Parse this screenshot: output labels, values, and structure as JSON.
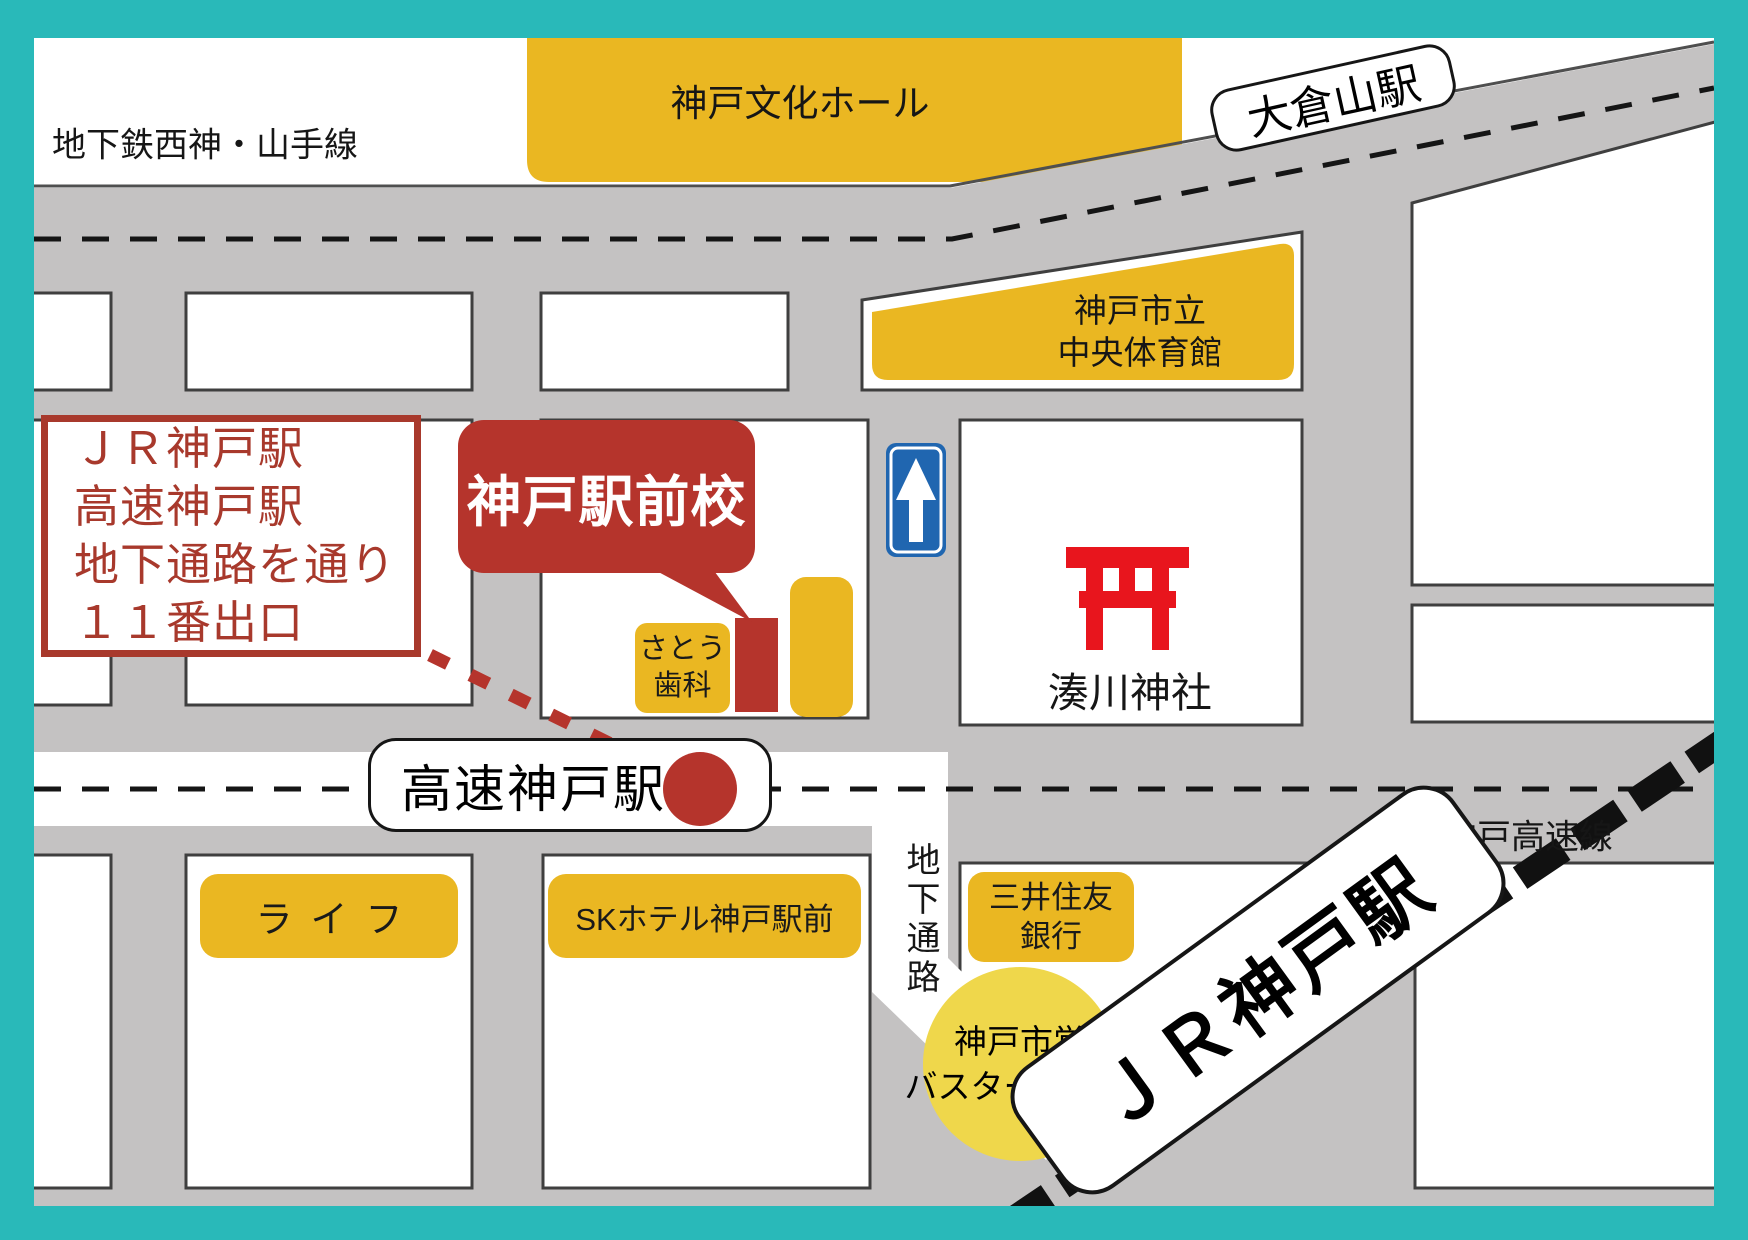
{
  "title": "神戸駅前校 アクセスマップ",
  "colors": {
    "frame_teal": "#29b9b9",
    "road_gray": "#c4c2c2",
    "building_yellow": "#eab722",
    "bus_circle_yellow": "#efd74b",
    "accent_red": "#b5342c",
    "info_red": "#a8392c",
    "torii_red": "#e8151d",
    "oneway_sign_blue": "#2066b0"
  },
  "rail_lines": {
    "subway_line": "地下鉄西神・山手線",
    "kosoku_line": "神戸高速線"
  },
  "stations": {
    "okurayama": "大倉山駅",
    "kosoku_kobe": "高速神戸駅",
    "jr_kobe": "ＪＲ神戸駅"
  },
  "info_box": {
    "lines": [
      "ＪＲ神戸駅",
      "高速神戸駅",
      "地下通路を通り",
      "１１番出口"
    ]
  },
  "school": {
    "callout": "神戸駅前校"
  },
  "places": {
    "culture_hall": "神戸文化ホール",
    "gym_line1": "神戸市立",
    "gym_line2": "中央体育館",
    "shrine": "湊川神社",
    "dental_line1": "さとう",
    "dental_line2": "歯科",
    "life": "ライフ",
    "sk_hotel": "SKホテル神戸駅前",
    "bank_line1": "三井住友",
    "bank_line2": "銀行",
    "bus_line1": "神戸市営",
    "bus_line2": "バスターミナル",
    "passage": "地下通路"
  }
}
